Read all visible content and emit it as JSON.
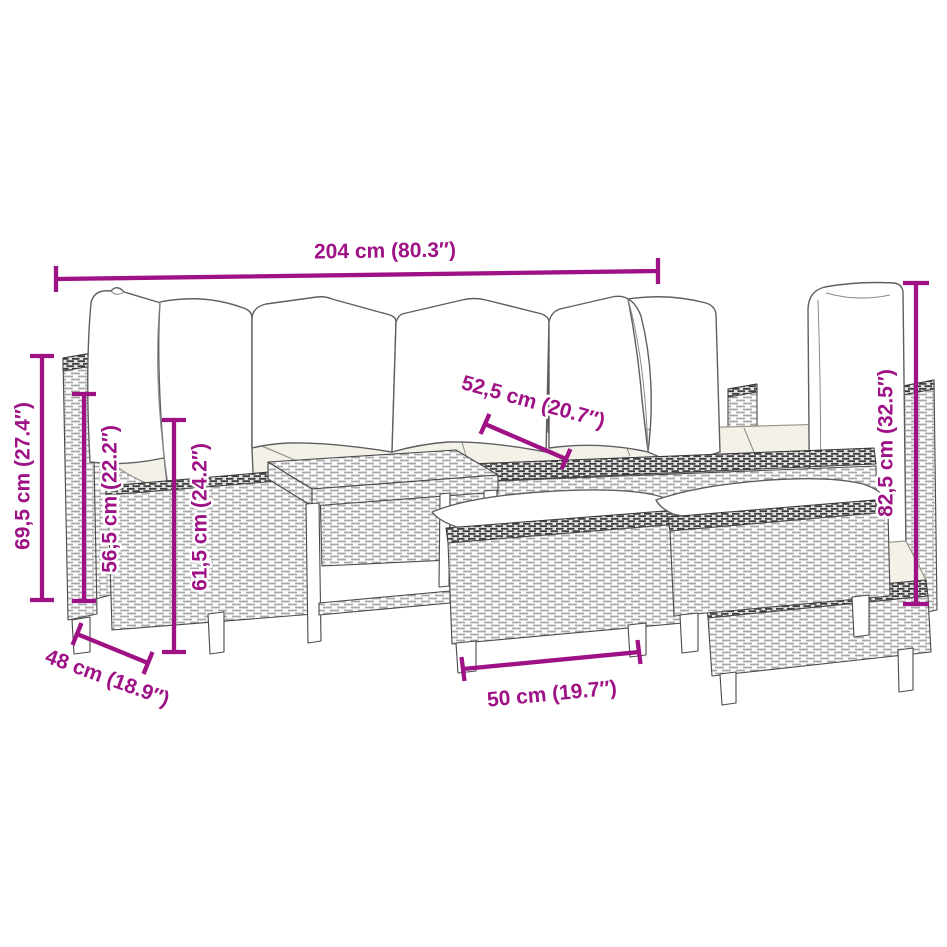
{
  "canvas": {
    "background": "#ffffff"
  },
  "style": {
    "dimension_color": "#9e1286",
    "furniture_line_color": "#4a4a4a",
    "seat_cushion_color": "#f4f1e9",
    "pillow_color": "#ffffff"
  },
  "dimensions": {
    "overall_width": {
      "label": "204 cm (80.3″)"
    },
    "seat_cushion_depth": {
      "label": "52,5 cm (20.7″)"
    },
    "backrest_height": {
      "label": "69,5 cm (27.4″)"
    },
    "armrest_height": {
      "label": "56,5 cm (22.2″)"
    },
    "seat_height": {
      "label": "61,5 cm (24.2″)"
    },
    "seat_depth": {
      "label": "48 cm (18.9″)"
    },
    "stool_width": {
      "label": "50 cm (19.7″)"
    },
    "right_backrest_height": {
      "label": "82,5 cm (32.5″)"
    }
  }
}
